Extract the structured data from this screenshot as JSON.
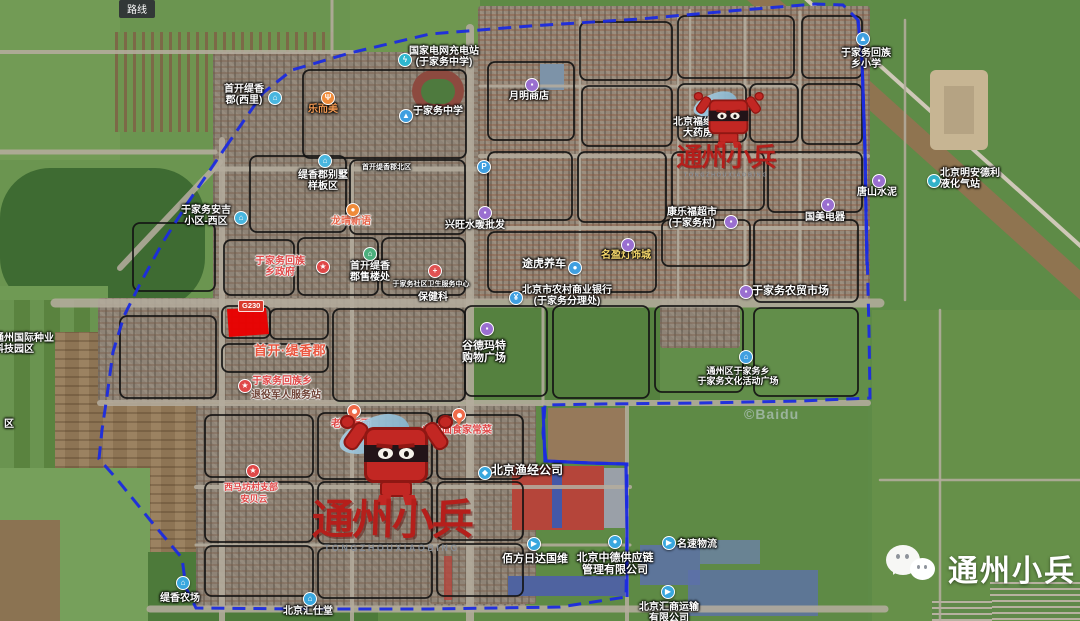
{
  "ui": {
    "route_button": "路线",
    "road_badge": "G230",
    "copyright": "©Baidu"
  },
  "watermarks": {
    "center": {
      "brand": "通州小兵",
      "caps": "TONGZHOUXIAOBING"
    },
    "top_right": {
      "brand": "通州小兵",
      "caps": "TONGZHOUXIAOBING"
    },
    "bottom_right": {
      "brand": "通州小兵"
    }
  },
  "boundary": {
    "color": "#1b2be0",
    "loop": [
      [
        225,
        148
      ],
      [
        263,
        93
      ],
      [
        292,
        70
      ],
      [
        350,
        53
      ],
      [
        430,
        34
      ],
      [
        530,
        26
      ],
      [
        640,
        19
      ],
      [
        730,
        11
      ],
      [
        815,
        4
      ],
      [
        843,
        5
      ],
      [
        858,
        20
      ],
      [
        862,
        60
      ],
      [
        865,
        150
      ],
      [
        867,
        250
      ],
      [
        869,
        330
      ],
      [
        870,
        398
      ],
      [
        800,
        401
      ],
      [
        700,
        403
      ],
      [
        600,
        404
      ],
      [
        545,
        405
      ],
      [
        543,
        433
      ],
      [
        546,
        461
      ],
      [
        590,
        463
      ],
      [
        627,
        464
      ],
      [
        627,
        530
      ],
      [
        626,
        597
      ],
      [
        560,
        607
      ],
      [
        430,
        609
      ],
      [
        300,
        609
      ],
      [
        196,
        608
      ],
      [
        186,
        588
      ],
      [
        182,
        558
      ],
      [
        150,
        520
      ],
      [
        116,
        478
      ],
      [
        99,
        459
      ],
      [
        102,
        430
      ],
      [
        107,
        396
      ],
      [
        113,
        352
      ],
      [
        124,
        316
      ],
      [
        141,
        282
      ],
      [
        163,
        242
      ],
      [
        189,
        201
      ],
      [
        225,
        148
      ]
    ],
    "solid_segments": [
      [
        [
          858,
          20
        ],
        [
          862,
          60
        ],
        [
          865,
          150
        ],
        [
          866,
          215
        ],
        [
          867,
          265
        ]
      ],
      [
        [
          543,
          407
        ],
        [
          545,
          461
        ],
        [
          590,
          463
        ],
        [
          626,
          464
        ],
        [
          627,
          530
        ],
        [
          627,
          597
        ]
      ]
    ]
  },
  "red_parcel": {
    "color": "#ea0000",
    "points": [
      [
        227,
        309
      ],
      [
        266,
        308
      ],
      [
        269,
        334
      ],
      [
        229,
        337
      ]
    ]
  },
  "labels": [
    {
      "name": "poi-shoukai-tixiang-xili",
      "x": 214,
      "y": 84,
      "w": 60,
      "lines": [
        "首开缇香",
        "郡(西里)"
      ],
      "icon": {
        "name": "residence-icon",
        "glyph": "⌂",
        "color": "#49b6df",
        "x": 268,
        "y": 91
      }
    },
    {
      "name": "poi-le-er-mei",
      "x": 300,
      "y": 104,
      "w": 46,
      "color": "#f49a52",
      "lines": [
        "乐而美"
      ],
      "icon": {
        "name": "restaurant-icon",
        "glyph": "Ψ",
        "color": "#ef8b3a",
        "x": 321,
        "y": 91
      }
    },
    {
      "name": "poi-tixiang-villa-area",
      "x": 288,
      "y": 170,
      "w": 70,
      "lines": [
        "缇香郡别墅",
        "样板区"
      ],
      "icon": {
        "name": "residence-icon",
        "glyph": "⌂",
        "color": "#49b6df",
        "x": 318,
        "y": 154
      }
    },
    {
      "name": "poi-tixiang-north-gate",
      "x": 362,
      "y": 164,
      "w": 52,
      "size": 7,
      "align": "left",
      "lines": [
        "首开缇香郡北区"
      ]
    },
    {
      "name": "poi-state-grid-charging",
      "x": 406,
      "y": 46,
      "w": 76,
      "lines": [
        "国家电网充电站",
        "(于家务中学)"
      ],
      "icon": {
        "name": "charging-icon",
        "glyph": "ϟ",
        "color": "#2fb7cf",
        "x": 398,
        "y": 53
      }
    },
    {
      "name": "poi-yujiawu-middle-school",
      "x": 410,
      "y": 106,
      "w": 56,
      "lines": [
        "于家务中学"
      ],
      "icon": {
        "name": "school-icon",
        "glyph": "▲",
        "color": "#3f9fe0",
        "x": 399,
        "y": 109
      }
    },
    {
      "name": "poi-yueming-store",
      "x": 506,
      "y": 91,
      "w": 46,
      "lines": [
        "月明商店"
      ],
      "icon": {
        "name": "shop-icon",
        "glyph": "▪",
        "color": "#9a6fd0",
        "x": 525,
        "y": 78
      }
    },
    {
      "name": "poi-fuyuantang-pharmacy",
      "x": 672,
      "y": 117,
      "w": 52,
      "lines": [
        "北京福缘堂",
        "大药房"
      ],
      "icon": {
        "name": "pharmacy-icon",
        "glyph": "+",
        "color": "#3f9fe0",
        "x": 696,
        "y": 102
      }
    },
    {
      "name": "poi-yujiawu-primary-school",
      "x": 838,
      "y": 48,
      "w": 56,
      "lines": [
        "于家务回族",
        "乡小学"
      ],
      "icon": {
        "name": "school-icon",
        "glyph": "▲",
        "color": "#3f9fe0",
        "x": 856,
        "y": 32
      }
    },
    {
      "name": "poi-tangshan-cement",
      "x": 855,
      "y": 187,
      "w": 44,
      "lines": [
        "唐山水泥"
      ],
      "icon": {
        "name": "shop-icon",
        "glyph": "▪",
        "color": "#9a6fd0",
        "x": 872,
        "y": 174
      }
    },
    {
      "name": "poi-mingandeli-gas-station",
      "x": 940,
      "y": 168,
      "w": 66,
      "align": "left",
      "lines": [
        "北京明安德利",
        "液化气站"
      ],
      "icon": {
        "name": "gas-icon",
        "glyph": "●",
        "color": "#33b2c8",
        "x": 927,
        "y": 174
      }
    },
    {
      "name": "poi-anji-community-west",
      "x": 180,
      "y": 205,
      "w": 52,
      "lines": [
        "于家务安吉",
        "小区-西区"
      ],
      "icon": {
        "name": "residence-icon",
        "glyph": "⌂",
        "color": "#49b6df",
        "x": 234,
        "y": 211
      }
    },
    {
      "name": "poi-longqing-xinyu",
      "x": 328,
      "y": 216,
      "w": 46,
      "color": "#e8654a",
      "halo": "light",
      "lines": [
        "龙晴新语"
      ],
      "icon": {
        "name": "residence-icon",
        "glyph": "●",
        "color": "#ef8b3a",
        "x": 346,
        "y": 203
      }
    },
    {
      "name": "poi-township-government",
      "x": 250,
      "y": 256,
      "w": 60,
      "color": "#e04848",
      "halo": "light",
      "lines": [
        "于家务回族",
        "乡政府"
      ],
      "icon": {
        "name": "star-badge-icon",
        "glyph": "★",
        "color": "#e04848",
        "x": 316,
        "y": 260
      }
    },
    {
      "name": "poi-tixiang-sales-office",
      "x": 344,
      "y": 261,
      "w": 52,
      "lines": [
        "首开缇香",
        "郡售楼处"
      ],
      "icon": {
        "name": "residence-icon",
        "glyph": "⌂",
        "color": "#4caf7d",
        "x": 363,
        "y": 247
      }
    },
    {
      "name": "poi-community-health-center",
      "x": 392,
      "y": 281,
      "w": 78,
      "size": 7,
      "lines": [
        "于家务社区卫生服务中心"
      ],
      "icon": {
        "name": "hospital-icon",
        "glyph": "+",
        "color": "#e05252",
        "x": 428,
        "y": 264
      }
    },
    {
      "name": "poi-baojianke",
      "x": 414,
      "y": 292,
      "w": 38,
      "lines": [
        "保健科"
      ]
    },
    {
      "name": "poi-parking",
      "icon": {
        "name": "parking-icon",
        "glyph": "P",
        "color": "#3f9fe0",
        "x": 477,
        "y": 160
      }
    },
    {
      "name": "poi-shuinuan-wholesale",
      "x": 442,
      "y": 220,
      "w": 66,
      "lines": [
        "兴旺水暖批发"
      ],
      "icon": {
        "name": "shop-icon",
        "glyph": "▪",
        "color": "#9a6fd0",
        "x": 478,
        "y": 206
      }
    },
    {
      "name": "poi-shoukai-tixiangjun",
      "x": 248,
      "y": 344,
      "w": 84,
      "size": 13,
      "bold": true,
      "color": "#ea5740",
      "halo": "light",
      "lines": [
        "首开·缇香郡"
      ]
    },
    {
      "name": "poi-huizu-township",
      "x": 248,
      "y": 376,
      "w": 68,
      "color": "#e04848",
      "halo": "light",
      "lines": [
        "于家务回族乡"
      ],
      "icon": {
        "name": "star-badge-icon",
        "glyph": "★",
        "color": "#e04848",
        "x": 238,
        "y": 379
      }
    },
    {
      "name": "poi-veterans-service-station",
      "x": 248,
      "y": 390,
      "w": 76,
      "color": "#6d4033",
      "halo": "light",
      "lines": [
        "退役军人服务站"
      ]
    },
    {
      "name": "poi-tuhu-car-care",
      "x": 519,
      "y": 258,
      "w": 50,
      "size": 11,
      "lines": [
        "途虎养车"
      ],
      "icon": {
        "name": "car-icon",
        "glyph": "●",
        "color": "#3f9fe0",
        "x": 568,
        "y": 261
      }
    },
    {
      "name": "poi-mingying-lighting-city",
      "x": 598,
      "y": 250,
      "w": 56,
      "color": "#f7d96d",
      "lines": [
        "名盈灯饰城"
      ],
      "icon": {
        "name": "shop-icon",
        "glyph": "▪",
        "color": "#9a6fd0",
        "x": 621,
        "y": 238
      }
    },
    {
      "name": "poi-kanglefu-supermarket",
      "x": 663,
      "y": 207,
      "w": 58,
      "lines": [
        "康乐福超市",
        "(于家务村)"
      ]
    },
    {
      "name": "poi-supermarket-icon-yujiawucun",
      "icon": {
        "name": "shop-icon",
        "glyph": "▪",
        "color": "#9a6fd0",
        "x": 724,
        "y": 215
      }
    },
    {
      "name": "poi-guomei-appliance",
      "x": 802,
      "y": 212,
      "w": 46,
      "lines": [
        "国美电器"
      ],
      "icon": {
        "name": "shop-icon",
        "glyph": "▪",
        "color": "#9a6fd0",
        "x": 821,
        "y": 198
      }
    },
    {
      "name": "poi-rural-commercial-bank",
      "x": 521,
      "y": 285,
      "w": 92,
      "lines": [
        "北京市农村商业银行",
        "(于家务分理处)"
      ],
      "icon": {
        "name": "bank-icon",
        "glyph": "¥",
        "color": "#3f9fe0",
        "x": 509,
        "y": 291
      }
    },
    {
      "name": "poi-gude-mart",
      "x": 458,
      "y": 340,
      "w": 52,
      "size": 11,
      "lines": [
        "谷德玛特",
        "购物广场"
      ],
      "icon": {
        "name": "shop-icon",
        "glyph": "▪",
        "color": "#9a6fd0",
        "x": 480,
        "y": 322
      }
    },
    {
      "name": "poi-farmers-market",
      "x": 752,
      "y": 285,
      "w": 80,
      "size": 11,
      "align": "left",
      "lines": [
        "于家务农贸市场"
      ],
      "icon": {
        "name": "shop-icon",
        "glyph": "▪",
        "color": "#9a6fd0",
        "x": 739,
        "y": 285
      }
    },
    {
      "name": "poi-culture-square",
      "x": 688,
      "y": 366,
      "w": 100,
      "size": 9,
      "lines": [
        "通州区于家务乡",
        "于家务文化活动广场"
      ],
      "icon": {
        "name": "landmark-icon",
        "glyph": "⌂",
        "color": "#3f9fe0",
        "x": 739,
        "y": 350
      }
    },
    {
      "name": "poi-seed-industry-park",
      "x": -6,
      "y": 333,
      "w": 66,
      "align": "left",
      "lines": [
        "通州国际种业",
        "科技园区"
      ]
    },
    {
      "name": "poi-qu-partial",
      "x": 2,
      "y": 419,
      "w": 14,
      "lines": [
        "区"
      ]
    },
    {
      "name": "poi-laocheng-noodle",
      "x": 328,
      "y": 419,
      "w": 46,
      "color": "#e04848",
      "halo": "light",
      "lines": [
        "老城板面"
      ],
      "icon": {
        "name": "pin-icon",
        "type": "pin",
        "color": "#ef6b4a",
        "x": 347,
        "y": 404
      }
    },
    {
      "name": "poi-shanxi-noodle",
      "x": 420,
      "y": 425,
      "w": 74,
      "color": "#e04848",
      "halo": "light",
      "lines": [
        "山西面食家常菜"
      ],
      "icon": {
        "name": "pin-icon",
        "type": "pin",
        "color": "#ef6b4a",
        "x": 452,
        "y": 408
      }
    },
    {
      "name": "poi-xima-village-branch",
      "x": 218,
      "y": 482,
      "w": 66,
      "size": 9,
      "color": "#e04848",
      "halo": "light",
      "lines": [
        "西马坊村支部"
      ],
      "icon": {
        "name": "star-badge-icon",
        "glyph": "★",
        "color": "#e04848",
        "x": 246,
        "y": 464
      }
    },
    {
      "name": "poi-anbeiyun",
      "x": 234,
      "y": 494,
      "w": 40,
      "size": 9,
      "color": "#e04848",
      "halo": "light",
      "lines": [
        "安贝云"
      ]
    },
    {
      "name": "poi-yujing-fishery",
      "x": 490,
      "y": 464,
      "w": 74,
      "size": 12,
      "lines": [
        "北京渔经公司"
      ],
      "icon": {
        "name": "company-icon",
        "glyph": "◆",
        "color": "#39a7de",
        "x": 478,
        "y": 466
      }
    },
    {
      "name": "poi-baifang-logistics",
      "x": 500,
      "y": 553,
      "w": 70,
      "size": 11,
      "lines": [
        "佰方日达国维"
      ],
      "icon": {
        "name": "truck-icon",
        "glyph": "▶",
        "color": "#39a7de",
        "x": 527,
        "y": 537
      }
    },
    {
      "name": "poi-zhongde-supply-chain",
      "x": 575,
      "y": 552,
      "w": 80,
      "size": 11,
      "lines": [
        "北京中德供应链",
        "管理有限公司"
      ],
      "icon": {
        "name": "company-icon",
        "glyph": "●",
        "color": "#39a7de",
        "x": 608,
        "y": 535
      }
    },
    {
      "name": "poi-mingsu-logistics",
      "x": 674,
      "y": 539,
      "w": 46,
      "lines": [
        "名速物流"
      ],
      "icon": {
        "name": "truck-icon",
        "glyph": "▶",
        "color": "#39a7de",
        "x": 662,
        "y": 536
      }
    },
    {
      "name": "poi-huishang-transport",
      "x": 634,
      "y": 602,
      "w": 70,
      "lines": [
        "北京汇商运输",
        "有限公司"
      ],
      "icon": {
        "name": "truck-icon",
        "glyph": "▶",
        "color": "#39a7de",
        "x": 661,
        "y": 585
      }
    },
    {
      "name": "poi-huishitang",
      "x": 280,
      "y": 606,
      "w": 56,
      "lines": [
        "北京汇仕堂"
      ],
      "icon": {
        "name": "company-icon",
        "glyph": "⌂",
        "color": "#39a7de",
        "x": 303,
        "y": 592
      }
    },
    {
      "name": "poi-tixiang-farm",
      "x": 156,
      "y": 593,
      "w": 48,
      "lines": [
        "缇香农场"
      ],
      "icon": {
        "name": "farm-icon",
        "glyph": "⌂",
        "color": "#39a7de",
        "x": 176,
        "y": 576
      }
    }
  ]
}
